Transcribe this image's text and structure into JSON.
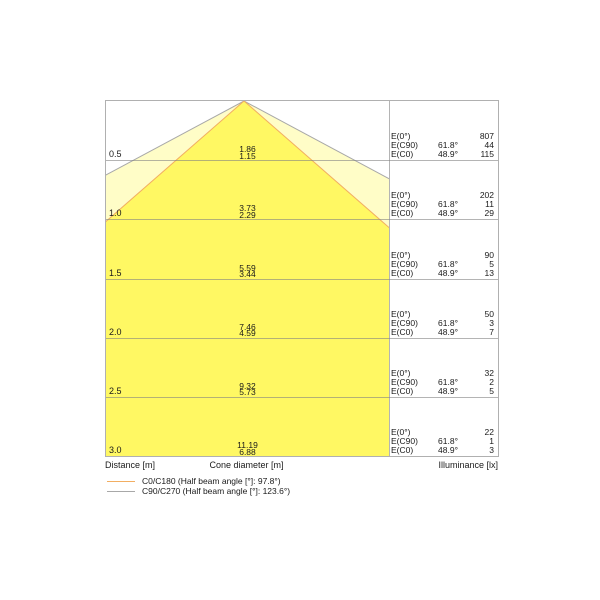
{
  "colors": {
    "beam_fill_outer": "rgba(255,244,0,0.22)",
    "beam_fill_inner": "rgba(255,244,0,0.5)",
    "c0_c180_line": "#f2ae62",
    "c90_c270_line": "#a8a8a8",
    "grid_line": "rgba(130,130,130,0.6)"
  },
  "axis_labels": {
    "distance": "Distance [m]",
    "cone_diameter": "Cone diameter [m]",
    "illuminance": "Illuminance [lx]"
  },
  "illuminance": {
    "labels": {
      "e0": "E(0°)",
      "ec90": "E(C90)",
      "ec0": "E(C0)"
    },
    "angles": {
      "c90": "61.8°",
      "c0": "48.9°"
    }
  },
  "legend": {
    "c0_c180": "C0/C180 (Half beam angle [°]: 97.8°)",
    "c90_c270": "C90/C270 (Half beam angle [°]: 123.6°)"
  },
  "rows": [
    {
      "distance": "0.5",
      "cone_wide": "1.86",
      "cone_narrow": "1.15",
      "e0": "807",
      "ec90": "44",
      "ec0": "115"
    },
    {
      "distance": "1.0",
      "cone_wide": "3.73",
      "cone_narrow": "2.29",
      "e0": "202",
      "ec90": "11",
      "ec0": "29"
    },
    {
      "distance": "1.5",
      "cone_wide": "5.59",
      "cone_narrow": "3.44",
      "e0": "90",
      "ec90": "5",
      "ec0": "13"
    },
    {
      "distance": "2.0",
      "cone_wide": "7.46",
      "cone_narrow": "4.59",
      "e0": "50",
      "ec90": "3",
      "ec0": "7"
    },
    {
      "distance": "2.5",
      "cone_wide": "9.32",
      "cone_narrow": "5.73",
      "e0": "32",
      "ec90": "2",
      "ec0": "5"
    },
    {
      "distance": "3.0",
      "cone_wide": "11.19",
      "cone_narrow": "6.88",
      "e0": "22",
      "ec90": "1",
      "ec0": "3"
    }
  ],
  "chart_data": {
    "type": "area",
    "subtype": "photometric-cone-diagram",
    "title": "",
    "xlabel": "Cone diameter [m]",
    "ylabel": "Distance [m]",
    "distances_m": [
      0.5,
      1.0,
      1.5,
      2.0,
      2.5,
      3.0
    ],
    "series": [
      {
        "name": "C0/C180 (Half beam angle [°]: 97.8°)",
        "half_beam_angle_deg": 97.8,
        "cone_diameter_m": [
          1.15,
          2.29,
          3.44,
          4.59,
          5.73,
          6.88
        ],
        "line_color": "#f2ae62"
      },
      {
        "name": "C90/C270 (Half beam angle [°]: 123.6°)",
        "half_beam_angle_deg": 123.6,
        "cone_diameter_m": [
          1.86,
          3.73,
          5.59,
          7.46,
          9.32,
          11.19
        ],
        "line_color": "#a8a8a8"
      }
    ],
    "illuminance_lx": [
      {
        "name": "E(0°)",
        "angle": null,
        "values": [
          807,
          202,
          90,
          50,
          32,
          22
        ]
      },
      {
        "name": "E(C90)",
        "angle": "61.8°",
        "values": [
          44,
          11,
          5,
          3,
          2,
          1
        ]
      },
      {
        "name": "E(C0)",
        "angle": "48.9°",
        "values": [
          115,
          29,
          13,
          7,
          5,
          3
        ]
      }
    ],
    "legend_position": "bottom-left",
    "grid": true
  }
}
